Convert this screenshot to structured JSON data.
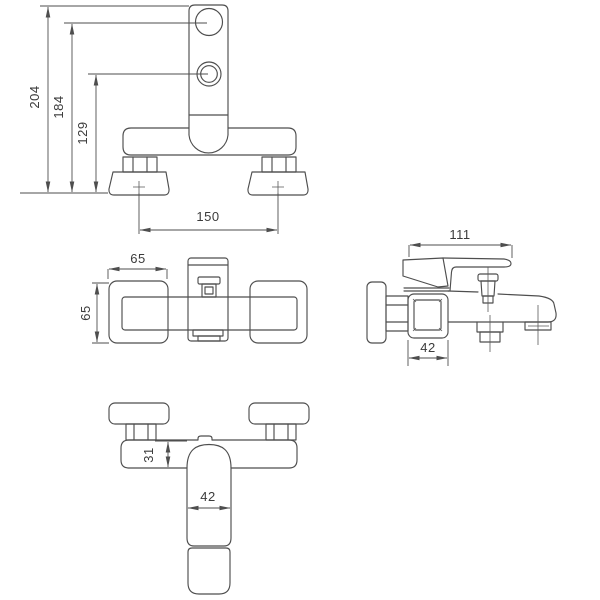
{
  "drawing": {
    "type": "technical-orthographic-drawing",
    "subject": "wall-mounted bath mixer tap",
    "background_color": "#ffffff",
    "line_color": "#4e4e4e",
    "text_color": "#3b3b3b",
    "views": {
      "front": {
        "label": "front view",
        "dims": {
          "overall_height": "204",
          "handle_port_height": "184",
          "diverter_port_height": "129",
          "mounting_centers": "150"
        }
      },
      "plan": {
        "label": "top view",
        "dims": {
          "flange_width": "65",
          "flange_depth": "65"
        }
      },
      "side": {
        "label": "side view",
        "dims": {
          "overall_projection": "111",
          "body_width": "42"
        }
      },
      "bottom": {
        "label": "bottom view",
        "dims": {
          "body_thickness": "31",
          "spout_width": "42"
        }
      }
    }
  }
}
